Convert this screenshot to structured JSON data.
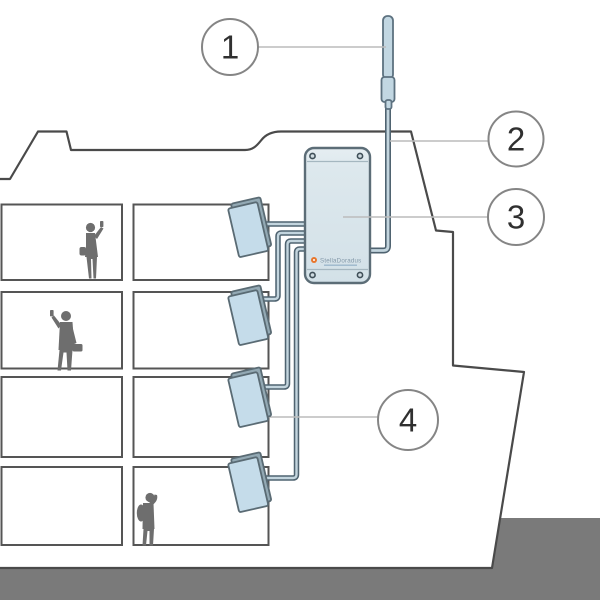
{
  "callouts": [
    {
      "number": "1"
    },
    {
      "number": "2"
    },
    {
      "number": "3"
    },
    {
      "number": "4"
    }
  ],
  "repeater": {
    "brand": "StellaDoradus"
  },
  "colors": {
    "outline": "#4a4a4a",
    "room_border": "#555555",
    "ground": "#7a7a7a",
    "silhouette": "#6e6e6e",
    "device_fill": "#dde8ed",
    "device_border": "#5c6d77",
    "antenna_fill": "#c5dcea",
    "antenna_edge": "#93a9b4",
    "rod_fill": "#c2d7e2",
    "rod_border": "#5d7280",
    "cable_dark": "#4f6370",
    "cable_light": "#c3d5de",
    "callout_border": "#858585",
    "callout_line": "#bcbcbc",
    "logo_accent": "#e8762c"
  }
}
